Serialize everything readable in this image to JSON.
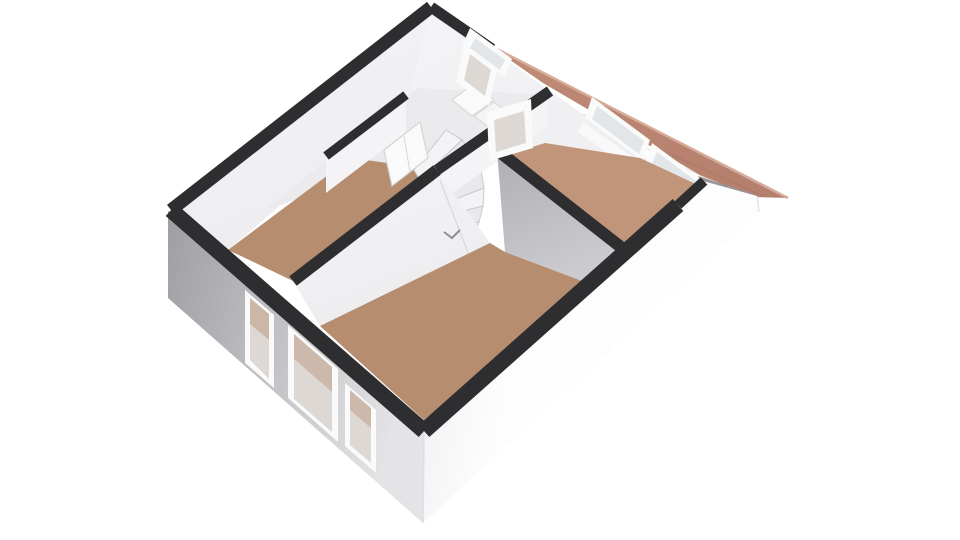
{
  "meta": {
    "type": "3d-floor-plan",
    "view": "axonometric-top-down",
    "text_visible": "none"
  },
  "colors": {
    "background": "#ffffff",
    "wall_top": "#2e2e31",
    "facade_left_dark": "#9e9ea3",
    "facade_left_light": "#e4e4e6",
    "facade_right": "#fdfdfe",
    "facade_right_shade": "#ededf0",
    "interior_white": "#f4f4f6",
    "interior_white_dim": "#ededef",
    "interior_shadow": "#aeaeb3",
    "interior_shadow_light": "#ccccd0",
    "floor_brown": "#b78d70",
    "floor_brown_light": "#c0957a",
    "floor_landing": "#eaeaec",
    "bath_floor": "#ebebed",
    "roof": "#b5806d",
    "roof_light": "#c08b77",
    "roof_shadow": "#a06f5e",
    "roof_ridge": "#d7ab99",
    "eave_shadow": "#97979b",
    "glass": "#e3e6e8",
    "frame_white": "#fafafa",
    "frame_edge": "#d5d5d8",
    "reveal_warm": "#ddd8d4",
    "stair_tread": "#f3f3f5",
    "stair_tread_alt": "#e9e9ec",
    "stair_edge": "#c9c9ce",
    "door_seam": "#d8d8db",
    "handle": "#8f8f95",
    "corner_edge": "#dedee1"
  },
  "scene": {
    "rooms": [
      {
        "id": "room-left",
        "floor_color_key": "floor_brown"
      },
      {
        "id": "room-center",
        "floor_color_key": "floor_brown"
      },
      {
        "id": "room-right",
        "floor_color_key": "floor_brown_light"
      },
      {
        "id": "landing-stairwell",
        "floor_color_key": "floor_landing",
        "features": [
          "winder-staircase",
          "door"
        ]
      },
      {
        "id": "bathroom-back",
        "floor_color_key": "bath_floor",
        "features": [
          "window",
          "fixtures",
          "door-frame"
        ]
      }
    ],
    "windows": {
      "front_facade_count": 3,
      "back_wall_right_room_count": 2,
      "bathroom_count": 1
    },
    "doors_count": 3,
    "staircase": {
      "style": "winder",
      "steps_visible": 8
    },
    "roof": {
      "visible_part": "right slope with overhang",
      "color_key": "roof"
    }
  }
}
